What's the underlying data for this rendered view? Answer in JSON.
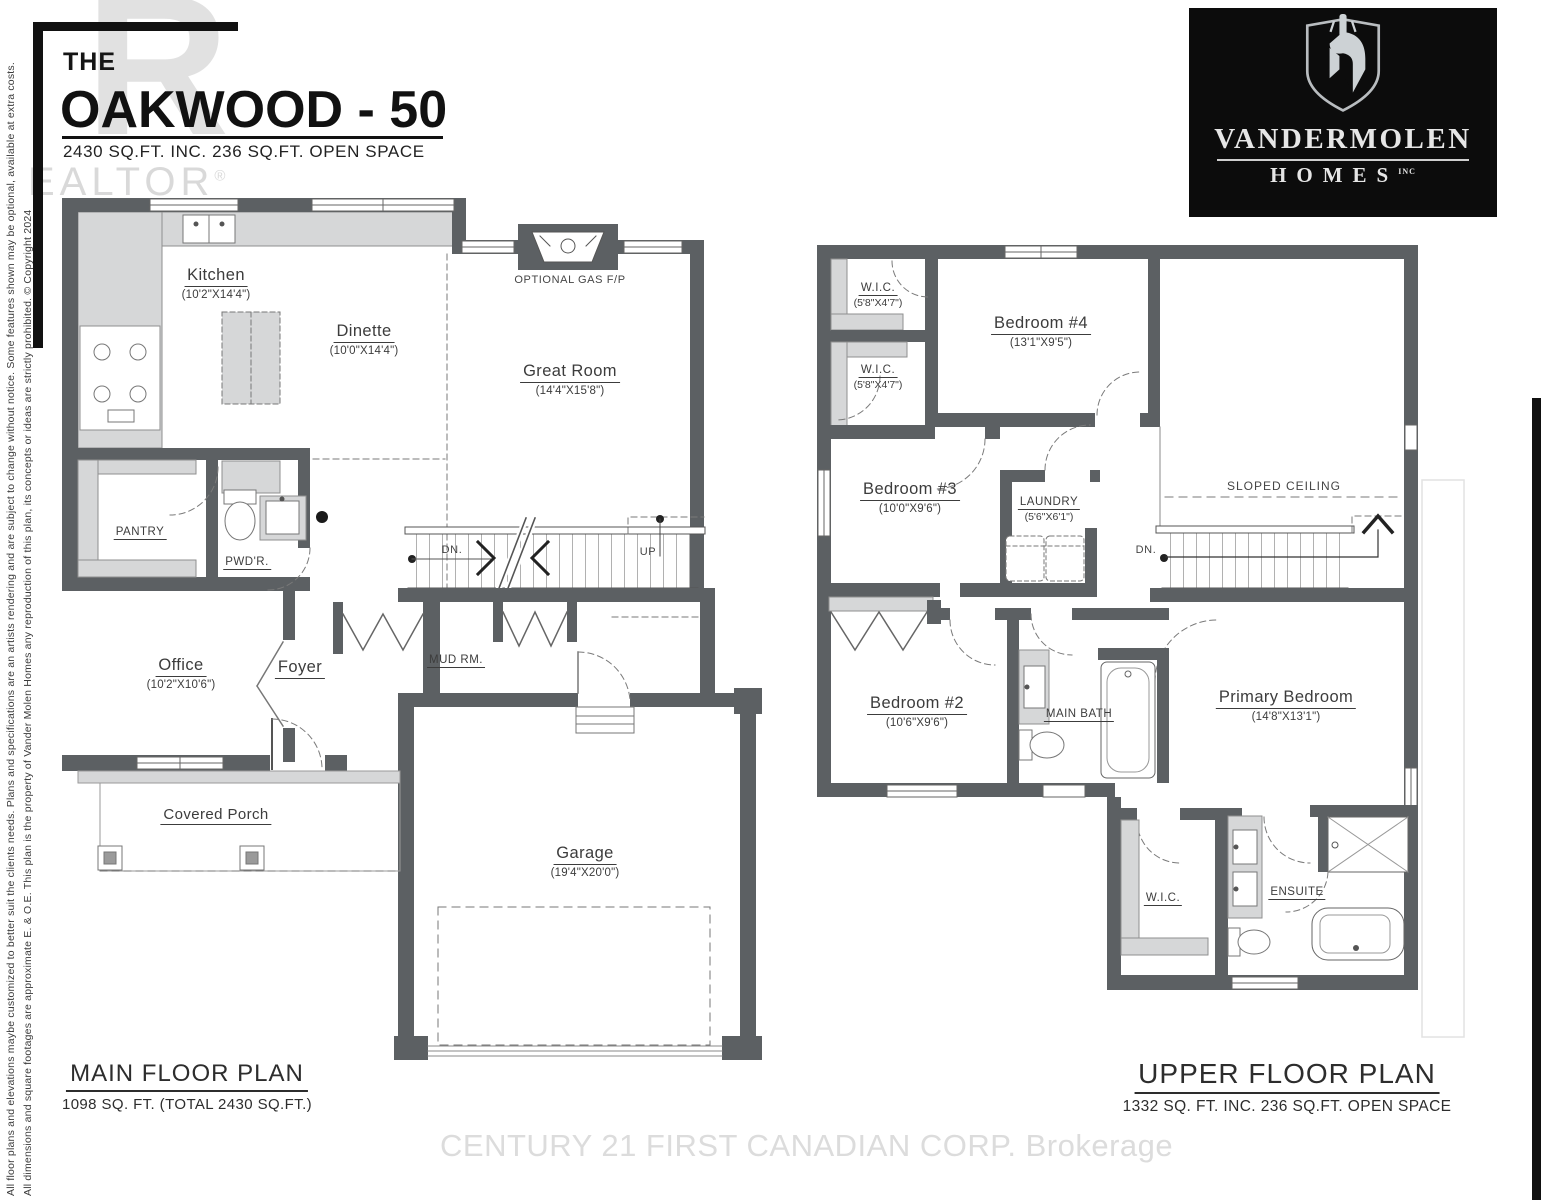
{
  "colors": {
    "wall": "#5c6063",
    "light_fill": "#d6d7d8",
    "ink": "#3c3c3c",
    "frame_black": "#111111",
    "watermark_gray": "#c9c9c9",
    "footer_watermark_gray": "#dcdcdc"
  },
  "header": {
    "kicker": "THE",
    "title": "OAKWOOD - 50",
    "subtitle": "2430 SQ.FT. INC. 236 SQ.FT. OPEN SPACE"
  },
  "realtor": {
    "big_r": "R",
    "rest": "EALTOR",
    "reg": "®"
  },
  "logo": {
    "brand": "VANDERMOLEN",
    "homes": "HOMES",
    "inc": "INC"
  },
  "side_notes": {
    "line1": "All floor plans and elevations maybe customized to better suit the clients needs. Plans and specifications are an artists rendering and are subject to change without notice. Some features shown may be optional, available at extra costs.",
    "line2": "All dimensions and square footages are approximate E. & O.E. This plan is the property of Vander Molen Homes any reproduction of this plan, its concepts or ideas are strictly prohibited. © Copyright 2024"
  },
  "footer_watermark": "CENTURY 21 FIRST CANADIAN CORP.  Brokerage",
  "main_floor": {
    "plan_title": "MAIN FLOOR PLAN",
    "plan_subtitle": "1098 SQ. FT. (TOTAL 2430 SQ.FT.)",
    "kitchen": {
      "name": "Kitchen",
      "dims": "(10'2\"X14'4\")"
    },
    "dinette": {
      "name": "Dinette",
      "dims": "(10'0\"X14'4\")"
    },
    "great_room": {
      "name": "Great Room",
      "dims": "(14'4\"X15'8\")"
    },
    "gas_fp": "OPTIONAL GAS F/P",
    "pantry": "PANTRY",
    "powder": "PWD'R.",
    "dn": "DN.",
    "up": "UP",
    "office": {
      "name": "Office",
      "dims": "(10'2\"X10'6\")"
    },
    "foyer": "Foyer",
    "mud_room": "MUD RM.",
    "covered_porch": "Covered Porch",
    "garage": {
      "name": "Garage",
      "dims": "(19'4\"X20'0\")"
    }
  },
  "upper_floor": {
    "plan_title": "UPPER FLOOR PLAN",
    "plan_subtitle": "1332 SQ. FT. INC. 236 SQ.FT. OPEN SPACE",
    "wic1": {
      "name": "W.I.C.",
      "dims": "(5'8\"X4'7\")"
    },
    "wic2": {
      "name": "W.I.C.",
      "dims": "(5'8\"X4'7\")"
    },
    "bedroom4": {
      "name": "Bedroom #4",
      "dims": "(13'1\"X9'5\")"
    },
    "bedroom3": {
      "name": "Bedroom #3",
      "dims": "(10'0\"X9'6\")"
    },
    "laundry": {
      "name": "LAUNDRY",
      "dims": "(5'6\"X6'1\")"
    },
    "sloped_ceiling": "SLOPED CEILING",
    "dn": "DN.",
    "bedroom2": {
      "name": "Bedroom #2",
      "dims": "(10'6\"X9'6\")"
    },
    "main_bath": "MAIN BATH",
    "primary_bedroom": {
      "name": "Primary Bedroom",
      "dims": "(14'8\"X13'1\")"
    },
    "wic3": "W.I.C.",
    "ensuite": "ENSUITE"
  }
}
